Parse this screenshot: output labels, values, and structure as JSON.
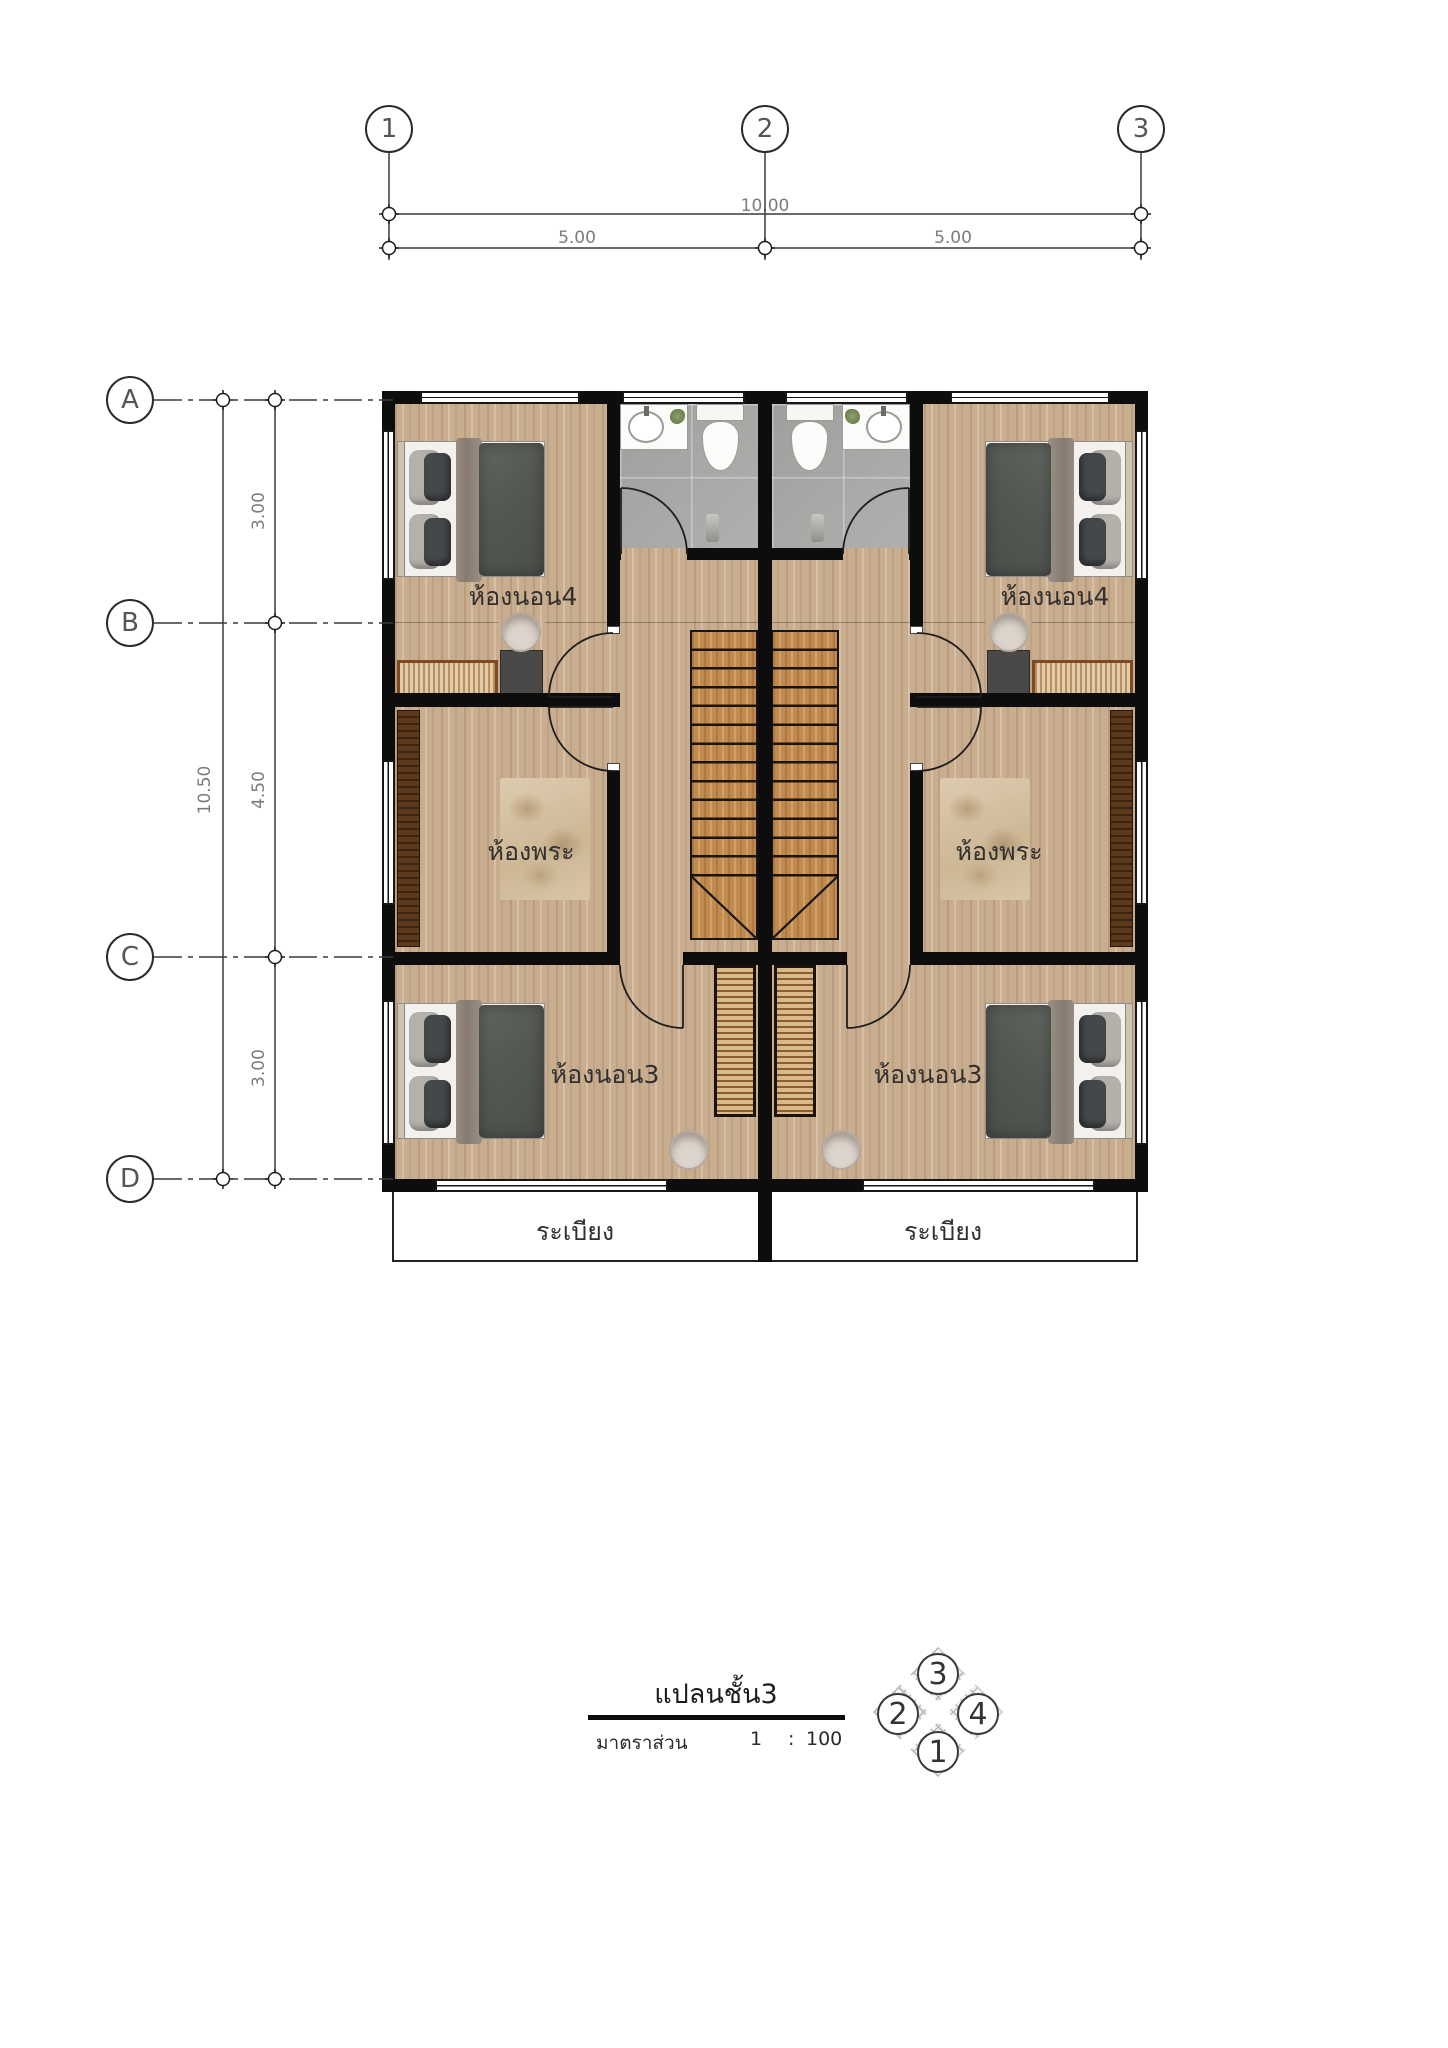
{
  "document": {
    "type": "architectural-floor-plan",
    "language": "Thai"
  },
  "grid": {
    "columns": {
      "c1": "1",
      "c2": "2",
      "c3": "3"
    },
    "rows": {
      "rA": "A",
      "rB": "B",
      "rC": "C",
      "rD": "D"
    }
  },
  "dimensions": {
    "top_total": "10.00",
    "top_seg1": "5.00",
    "top_seg2": "5.00",
    "left_total": "10.50",
    "left_seg1": "3.00",
    "left_seg2": "4.50",
    "left_seg3": "3.00"
  },
  "labels": {
    "bedroom4_left": "ห้องนอน4",
    "bedroom4_right": "ห้องนอน4",
    "prayer_left": "ห้องพระ",
    "prayer_right": "ห้องพระ",
    "bedroom3_left": "ห้องนอน3",
    "bedroom3_right": "ห้องนอน3",
    "balcony_left": "ระเบียง",
    "balcony_right": "ระเบียง"
  },
  "title_block": {
    "plan_title": "แปลนชั้น3",
    "scale_label": "มาตราส่วน",
    "scale_value_1": "1",
    "scale_sep": ":",
    "scale_value_2": "100"
  },
  "compass": {
    "top": "3",
    "left": "2",
    "right": "4",
    "bottom": "1"
  },
  "colors": {
    "wall": "#0d0d0d",
    "wood_floor": "#c9ad8f",
    "stair_wood": "#c18a4e",
    "bathroom_tile": "#a9a9a7",
    "room_label_text": "#303030",
    "dimension_text": "#7c7c7c"
  }
}
